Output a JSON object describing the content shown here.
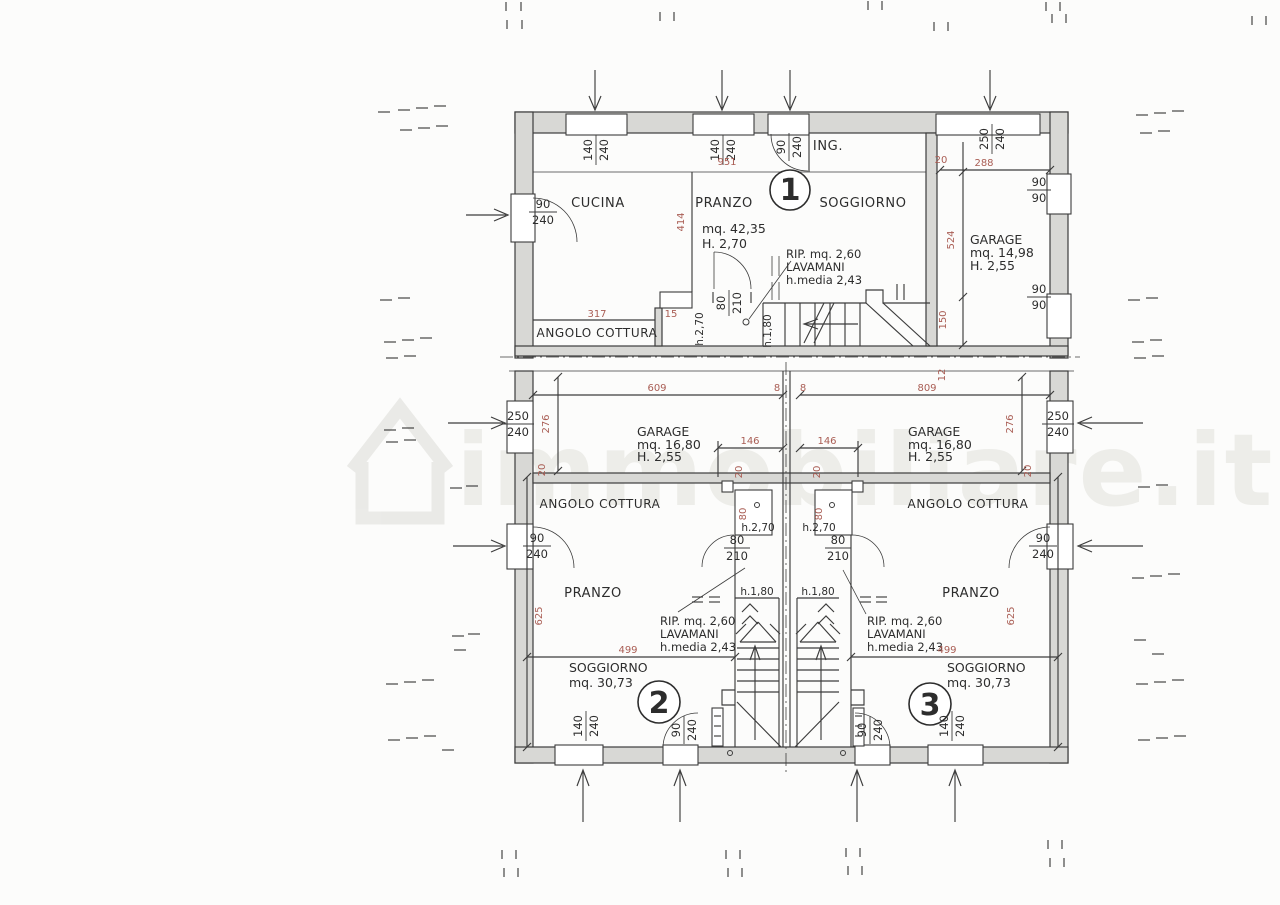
{
  "watermark": {
    "text": "immobiliare.it"
  },
  "unit1": {
    "number": "1",
    "ing": "ING.",
    "cucina": "CUCINA",
    "pranzo": "PRANZO",
    "soggiorno": "SOGGIORNO",
    "area": "mq.  42,35",
    "height": "H. 2,70",
    "rip": "RIP. mq. 2,60",
    "lavamani": "LAVAMANI",
    "hmedia": "h.media 2,43",
    "angolo": "ANGOLO COTTURA",
    "h270": "h.2,70",
    "h180": "h.1,80",
    "win1_top": "140",
    "win1_bot": "240",
    "win2_top": "140",
    "win2_bot": "240",
    "ing_top": "90",
    "ing_bot": "240",
    "left_top": "90",
    "left_bot": "240",
    "door_top": "80",
    "door_bot": "210",
    "d951": "951",
    "d414": "414",
    "d317": "317",
    "d15": "15"
  },
  "garage1": {
    "name": "GARAGE",
    "area": "mq.  14,98",
    "height": "H. 2,55",
    "door_top": "250",
    "door_bot": "240",
    "winA_top": "90",
    "winA_bot": "90",
    "winB_top": "90",
    "winB_bot": "90",
    "d20": "20",
    "d288": "288",
    "d524": "524",
    "d150": "150",
    "d12": "12"
  },
  "mid": {
    "d609": "609",
    "d8a": "8",
    "d8b": "8",
    "d809": "809",
    "g2_name": "GARAGE",
    "g2_area": "mq.  16,80",
    "g2_height": "H. 2,55",
    "g3_name": "GARAGE",
    "g3_area": "mq.  16,80",
    "g3_height": "H. 2,55",
    "d146a": "146",
    "d146b": "146",
    "d276a": "276",
    "d276b": "276",
    "d20a": "20",
    "d20b": "20",
    "d20c": "20",
    "d20d": "20",
    "gdoorL_top": "250",
    "gdoorL_bot": "240",
    "gdoorR_top": "250",
    "gdoorR_bot": "240"
  },
  "unit2": {
    "number": "2",
    "pranzo": "PRANZO",
    "angolo": "ANGOLO COTTURA",
    "soggiorno": "SOGGIORNO",
    "area": "mq.  30,73",
    "rip": "RIP. mq. 2,60",
    "lavamani": "LAVAMANI",
    "hmedia": "h.media 2,43",
    "d499": "499",
    "d625": "625",
    "win_top": "140",
    "win_bot": "240",
    "door_top": "90",
    "door_bot": "240",
    "side_top": "90",
    "side_bot": "240"
  },
  "unit3": {
    "number": "3",
    "pranzo": "PRANZO",
    "angolo": "ANGOLO COTTURA",
    "soggiorno": "SOGGIORNO",
    "area": "mq.  30,73",
    "rip": "RIP. mq. 2,60",
    "lavamani": "LAVAMANI",
    "hmedia": "h.media 2,43",
    "d499": "499",
    "d625": "625",
    "win_top": "140",
    "win_bot": "240",
    "door_top": "90",
    "door_bot": "240",
    "side_top": "90",
    "side_bot": "240"
  },
  "stairs": {
    "h270a": "h.2,70",
    "h270b": "h.2,70",
    "h180a": "h.1,80",
    "h180b": "h.1,80",
    "doorA_top": "80",
    "doorA_bot": "210",
    "doorB_top": "80",
    "doorB_bot": "210",
    "d80a": "80",
    "d80b": "80"
  }
}
